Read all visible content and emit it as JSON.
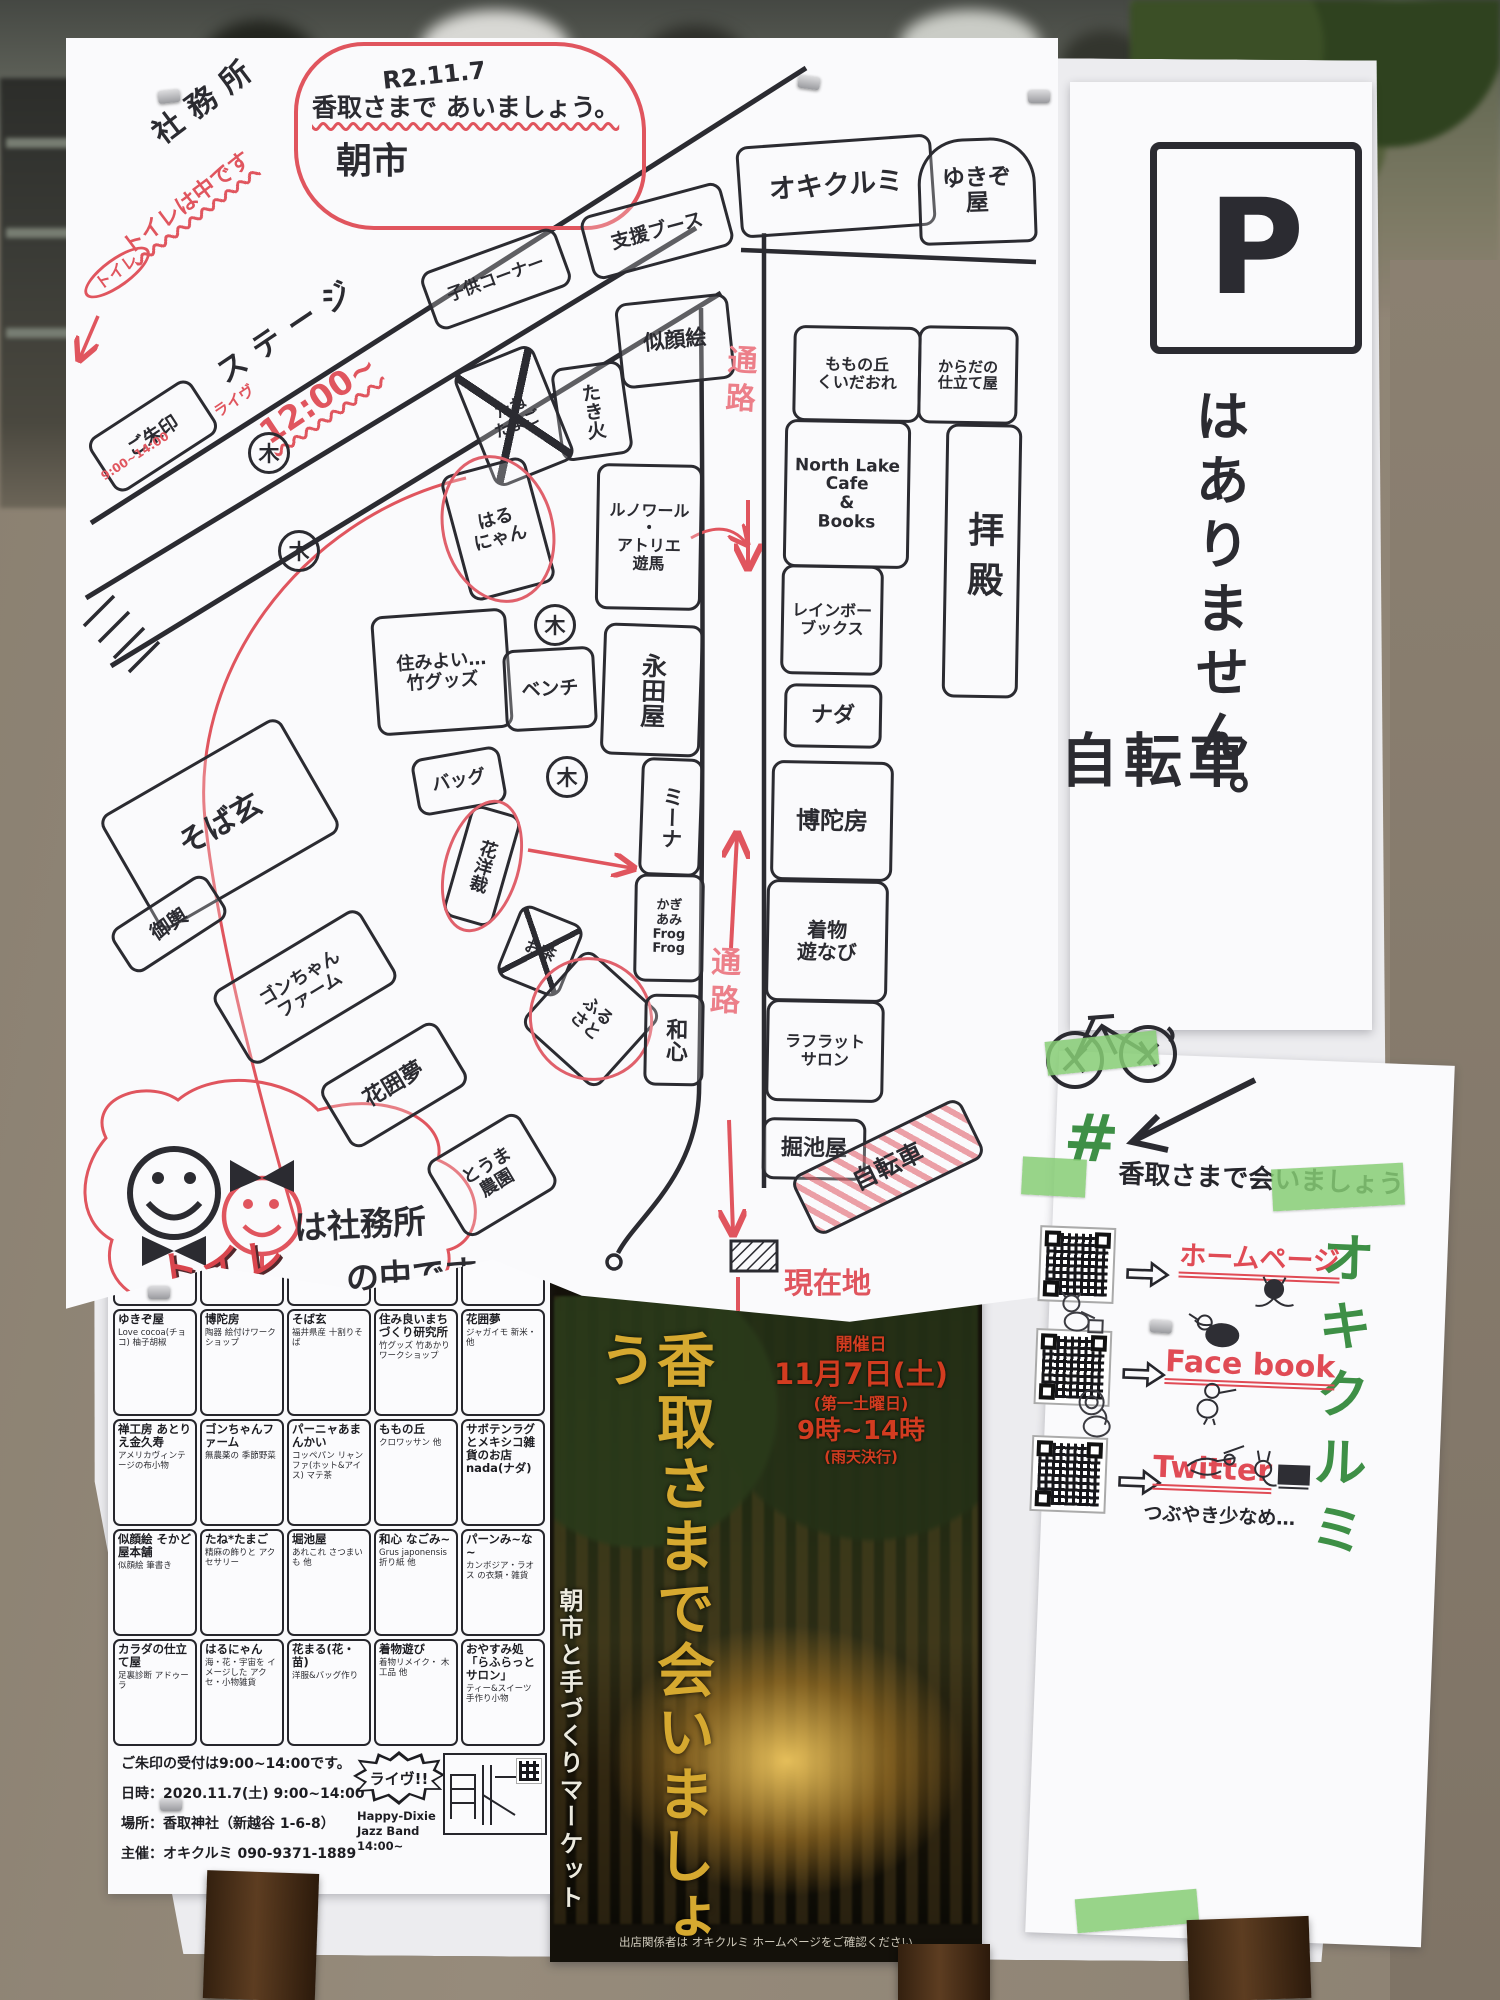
{
  "map": {
    "cloud": {
      "date": "R2.11.7",
      "line1": "香取さまで あいましょう。",
      "line2": "朝市"
    },
    "labels": {
      "tree": "木",
      "bicycle_crossed": "自転車"
    },
    "notes": [
      {
        "t": "社務所",
        "x": 78,
        "y": 46,
        "r": -37,
        "fs": 30,
        "cls": "ink sp"
      },
      {
        "t": "トイレは中です",
        "x": 44,
        "y": 154,
        "r": -37,
        "fs": 22,
        "cls": "red wavy"
      },
      {
        "t": "トイレ",
        "x": 12,
        "y": 220,
        "r": -36,
        "fs": 16,
        "cls": "red ring"
      },
      {
        "t": "ステージ",
        "x": 140,
        "y": 276,
        "r": -34,
        "fs": 30,
        "cls": "ink sp"
      },
      {
        "t": "ライヴ",
        "x": 146,
        "y": 356,
        "r": -34,
        "fs": 15,
        "cls": "red"
      },
      {
        "t": "12:00~",
        "x": 186,
        "y": 344,
        "r": -34,
        "fs": 33,
        "cls": "red wavy"
      },
      {
        "t": "9:00~14:00",
        "x": 30,
        "y": 412,
        "r": -33,
        "fs": 12,
        "cls": "red"
      },
      {
        "t": "通路",
        "x": 656,
        "y": 306,
        "r": 3,
        "fs": 30,
        "cls": "redv vert"
      },
      {
        "t": "通路",
        "x": 640,
        "y": 908,
        "r": 2,
        "fs": 30,
        "cls": "redv vert"
      },
      {
        "t": "現在地",
        "x": 718,
        "y": 1230,
        "r": 0,
        "fs": 29,
        "cls": "red"
      },
      {
        "t": "は社務所",
        "x": 228,
        "y": 1170,
        "r": -3,
        "fs": 33,
        "cls": "ink"
      },
      {
        "t": "の中です。",
        "x": 280,
        "y": 1220,
        "r": -3,
        "fs": 33,
        "cls": "ink"
      },
      {
        "t": "トイレ",
        "x": 92,
        "y": 1206,
        "r": -8,
        "fs": 40,
        "cls": "tblock"
      }
    ],
    "trees": [
      {
        "x": 182,
        "y": 394
      },
      {
        "x": 212,
        "y": 492
      },
      {
        "x": 468,
        "y": 566
      },
      {
        "x": 480,
        "y": 718
      }
    ],
    "stalls": [
      {
        "label": "子供コーナー",
        "x": 358,
        "y": 210,
        "w": 138,
        "h": 56,
        "r": -20,
        "fs": 17
      },
      {
        "label": "支援ブース",
        "x": 518,
        "y": 160,
        "w": 140,
        "h": 60,
        "r": -15,
        "fs": 19
      },
      {
        "label": "オキクルミ",
        "x": 672,
        "y": 102,
        "w": 190,
        "h": 86,
        "r": -4,
        "fs": 27
      },
      {
        "label": "ゆきぞ\n屋",
        "x": 852,
        "y": 100,
        "w": 112,
        "h": 100,
        "r": -2,
        "fs": 23,
        "cls": "arch"
      },
      {
        "label": "似顔絵",
        "x": 552,
        "y": 260,
        "w": 108,
        "h": 80,
        "r": -6,
        "fs": 21
      },
      {
        "label": "たき火",
        "x": 490,
        "y": 326,
        "w": 66,
        "h": 88,
        "r": -8,
        "fs": 19,
        "cls": "vert"
      },
      {
        "label": "たね\nたまご",
        "x": 405,
        "y": 316,
        "w": 80,
        "h": 118,
        "r": -22,
        "fs": 16,
        "cls": "crossed"
      },
      {
        "label": "はる\nにゃん",
        "x": 388,
        "y": 426,
        "w": 82,
        "h": 124,
        "r": -15,
        "fs": 18,
        "cls": "oval"
      },
      {
        "label": "住みよい…\n竹グッズ",
        "x": 308,
        "y": 574,
        "w": 130,
        "h": 114,
        "r": -4,
        "fs": 18
      },
      {
        "label": "ベンチ",
        "x": 438,
        "y": 610,
        "w": 86,
        "h": 76,
        "r": -3,
        "fs": 19
      },
      {
        "label": "バッグ",
        "x": 348,
        "y": 714,
        "w": 84,
        "h": 52,
        "r": -10,
        "fs": 18
      },
      {
        "label": "花洋裁",
        "x": 390,
        "y": 770,
        "w": 46,
        "h": 110,
        "r": 16,
        "fs": 18,
        "cls": "vert oval"
      },
      {
        "label": "お茶",
        "x": 440,
        "y": 874,
        "w": 62,
        "h": 72,
        "r": 22,
        "fs": 16,
        "cls": "crossed"
      },
      {
        "label": "ふる\nさと",
        "x": 474,
        "y": 930,
        "w": 96,
        "h": 96,
        "r": 42,
        "fs": 17,
        "cls": "oval"
      },
      {
        "label": "そば玄",
        "x": 50,
        "y": 720,
        "w": 202,
        "h": 126,
        "r": -30,
        "fs": 30
      },
      {
        "label": "御輿",
        "x": 46,
        "y": 860,
        "w": 108,
        "h": 46,
        "r": -33,
        "fs": 20
      },
      {
        "label": "ゴンちゃん\nファーム",
        "x": 153,
        "y": 906,
        "w": 166,
        "h": 80,
        "r": -31,
        "fs": 18
      },
      {
        "label": "花囲夢",
        "x": 260,
        "y": 1010,
        "w": 130,
        "h": 68,
        "r": -31,
        "fs": 22
      },
      {
        "label": "とうま\n農園",
        "x": 372,
        "y": 1093,
        "w": 102,
        "h": 82,
        "r": -31,
        "fs": 18
      },
      {
        "label": "ルノワール\n・\nアトリエ\n遊馬",
        "x": 530,
        "y": 426,
        "w": 100,
        "h": 140,
        "r": 1,
        "fs": 16
      },
      {
        "label": "永田屋",
        "x": 536,
        "y": 586,
        "w": 94,
        "h": 126,
        "r": 2,
        "fs": 25,
        "cls": "vert"
      },
      {
        "label": "ミーナ",
        "x": 574,
        "y": 720,
        "w": 56,
        "h": 112,
        "r": 2,
        "fs": 21,
        "cls": "vert"
      },
      {
        "label": "かぎ\nあみ\nFrog\nFrog",
        "x": 568,
        "y": 836,
        "w": 64,
        "h": 102,
        "r": 1,
        "fs": 13
      },
      {
        "label": "和心",
        "x": 578,
        "y": 956,
        "w": 54,
        "h": 86,
        "r": 1,
        "fs": 22,
        "cls": "vert"
      },
      {
        "label": "ご朱印",
        "x": 26,
        "y": 366,
        "w": 116,
        "h": 58,
        "r": -33,
        "fs": 19
      },
      {
        "label": "ももの丘\nくいだおれ",
        "x": 727,
        "y": 288,
        "w": 122,
        "h": 90,
        "r": 1,
        "fs": 16
      },
      {
        "label": "からだの\n仕立て屋",
        "x": 852,
        "y": 288,
        "w": 94,
        "h": 92,
        "r": 1,
        "fs": 15
      },
      {
        "label": "North Lake\nCafe\n&\nBooks",
        "x": 718,
        "y": 382,
        "w": 120,
        "h": 142,
        "r": 1,
        "fs": 17
      },
      {
        "label": "レインボー\nブックス",
        "x": 715,
        "y": 527,
        "w": 96,
        "h": 104,
        "r": 1,
        "fs": 16
      },
      {
        "label": "ナダ",
        "x": 718,
        "y": 646,
        "w": 92,
        "h": 58,
        "r": 1,
        "fs": 22
      },
      {
        "label": "博陀房",
        "x": 705,
        "y": 723,
        "w": 116,
        "h": 114,
        "r": 1,
        "fs": 24
      },
      {
        "label": "着物\n遊なび",
        "x": 700,
        "y": 842,
        "w": 116,
        "h": 116,
        "r": 1,
        "fs": 20
      },
      {
        "label": "ラフラット\nサロン",
        "x": 700,
        "y": 962,
        "w": 112,
        "h": 96,
        "r": 1,
        "fs": 16
      },
      {
        "label": "掘池屋",
        "x": 696,
        "y": 1080,
        "w": 98,
        "h": 56,
        "r": 1,
        "fs": 22
      },
      {
        "label": "拝殿",
        "x": 878,
        "y": 386,
        "w": 70,
        "h": 268,
        "r": 1,
        "fs": 36,
        "cls": "vert sp2"
      },
      {
        "label": "自転車",
        "x": 728,
        "y": 1096,
        "w": 182,
        "h": 60,
        "r": -26,
        "fs": 25,
        "cls": "redhatch"
      }
    ]
  },
  "right_note": {
    "p": "P",
    "no_parking": "はありません。",
    "bicycle": "自転車"
  },
  "vendor_list": {
    "header": "香取さまで会いましょう。11月出店者さん一覧",
    "cells": [
      {
        "name": "オキクルミ",
        "desc": "わらび餅・煮物 支援ブース 他"
      },
      {
        "name": "ふるさと",
        "desc": "お赤飯・おこわ おそうざい・他"
      },
      {
        "name": "長田製紙所",
        "desc": "手すき和紙の 御朱印帳 他"
      },
      {
        "name": "ルノワール",
        "desc": "ヴィンテージアクセ 雑貨・他"
      },
      {
        "name": "North Lake Cafe&Books",
        "desc": "珈琲・ランチ 古本・他"
      },
      {
        "name": "レインボー ブックス",
        "desc": "古本"
      },
      {
        "name": "永田屋",
        "desc": "ビール・お酒 甘酒・ナツメ・茶・他"
      },
      {
        "name": "そうま農園",
        "desc": "無農薬の 季節野菜"
      },
      {
        "name": "アトリエ遊馬",
        "desc": "アクセサリー バッグ・他"
      },
      {
        "name": "くいだおれ",
        "desc": "お好み焼・他 カキ・ホタテバター"
      },
      {
        "name": "ゆきぞ屋",
        "desc": "Love cocoa(チョコ) 柚子胡椒"
      },
      {
        "name": "博陀房",
        "desc": "陶器 絵付けワークショップ"
      },
      {
        "name": "そば玄",
        "desc": "福井県産 十割りそば"
      },
      {
        "name": "住み良いまちづくり研究所",
        "desc": "竹グッズ 竹あかりワークショップ"
      },
      {
        "name": "花囲夢",
        "desc": "ジャガイモ 新米・他"
      },
      {
        "name": "禅工房 あとりえ金久寿",
        "desc": "アメリカヴィンテージの布小物"
      },
      {
        "name": "ゴンちゃんファーム",
        "desc": "無農薬の 季節野菜"
      },
      {
        "name": "パーニャあまんかい",
        "desc": "コッペパン リャンファ(ホット&アイス) マテ茶"
      },
      {
        "name": "ももの丘",
        "desc": "クロワッサン 他"
      },
      {
        "name": "サボテンラグとメキシコ雑貨のお店 nada(ナダ)",
        "desc": ""
      },
      {
        "name": "似顔絵 そかど屋本舗",
        "desc": "似顔絵 筆書き"
      },
      {
        "name": "たね*たまご",
        "desc": "精麻の飾りと アクセサリー"
      },
      {
        "name": "堀池屋",
        "desc": "あれこれ さつまいも 他"
      },
      {
        "name": "和心 なごみ~",
        "desc": "Grus japonensis 折り紙 他"
      },
      {
        "name": "パーンみ~な~",
        "desc": "カンボジア・ラオス の衣類・雑貨"
      },
      {
        "name": "カラダの仕立て屋",
        "desc": "足裏診断 アドゥーラ"
      },
      {
        "name": "はるにゃん",
        "desc": "海・花・宇宙を イメージした アクセ・小物雑貨"
      },
      {
        "name": "花まる(花・苗)",
        "desc": "洋服&バッグ作り"
      },
      {
        "name": "着物遊び",
        "desc": "着物リメイク・ 木工品 他"
      },
      {
        "name": "おやすみ処 「らふらっとサロン」",
        "desc": "ティー&スイーツ 手作り小物"
      }
    ],
    "footer": {
      "lines": [
        "ご朱印の受付は9:00~14:00です。",
        "日時：2020.11.7(土) 9:00~14:00",
        "場所：香取神社（新越谷 1-6-8）",
        "主催：オキクルミ 090-9371-1889"
      ],
      "live": [
        "ライヴ!!",
        "Happy-Dixie",
        "Jazz Band",
        "14:00~"
      ]
    }
  },
  "poster": {
    "dates": [
      "開催日",
      "11月7日(土)",
      "(第一土曜日)",
      "9時~14時",
      "(雨天決行)"
    ],
    "title": "香取さまで会いましょう",
    "subtitle": "朝市と手づくりマーケット",
    "caption": "出店関係者は オキクルミ ホームページをご確認ください"
  },
  "sns": {
    "hash": "#",
    "title": "香取さまで会いましょう",
    "brand": "オキクルミ",
    "links": [
      {
        "label": "ホームページ"
      },
      {
        "label": "Face book"
      },
      {
        "label": "Twitter",
        "note": "つぶやき少なめ…"
      }
    ]
  },
  "colors": {
    "marker": "#2b2b31",
    "red": "#e0555e",
    "gold": "#d6a930",
    "tape": "#86cc74",
    "green": "#3e8f46",
    "poster_red": "#d23c20"
  }
}
